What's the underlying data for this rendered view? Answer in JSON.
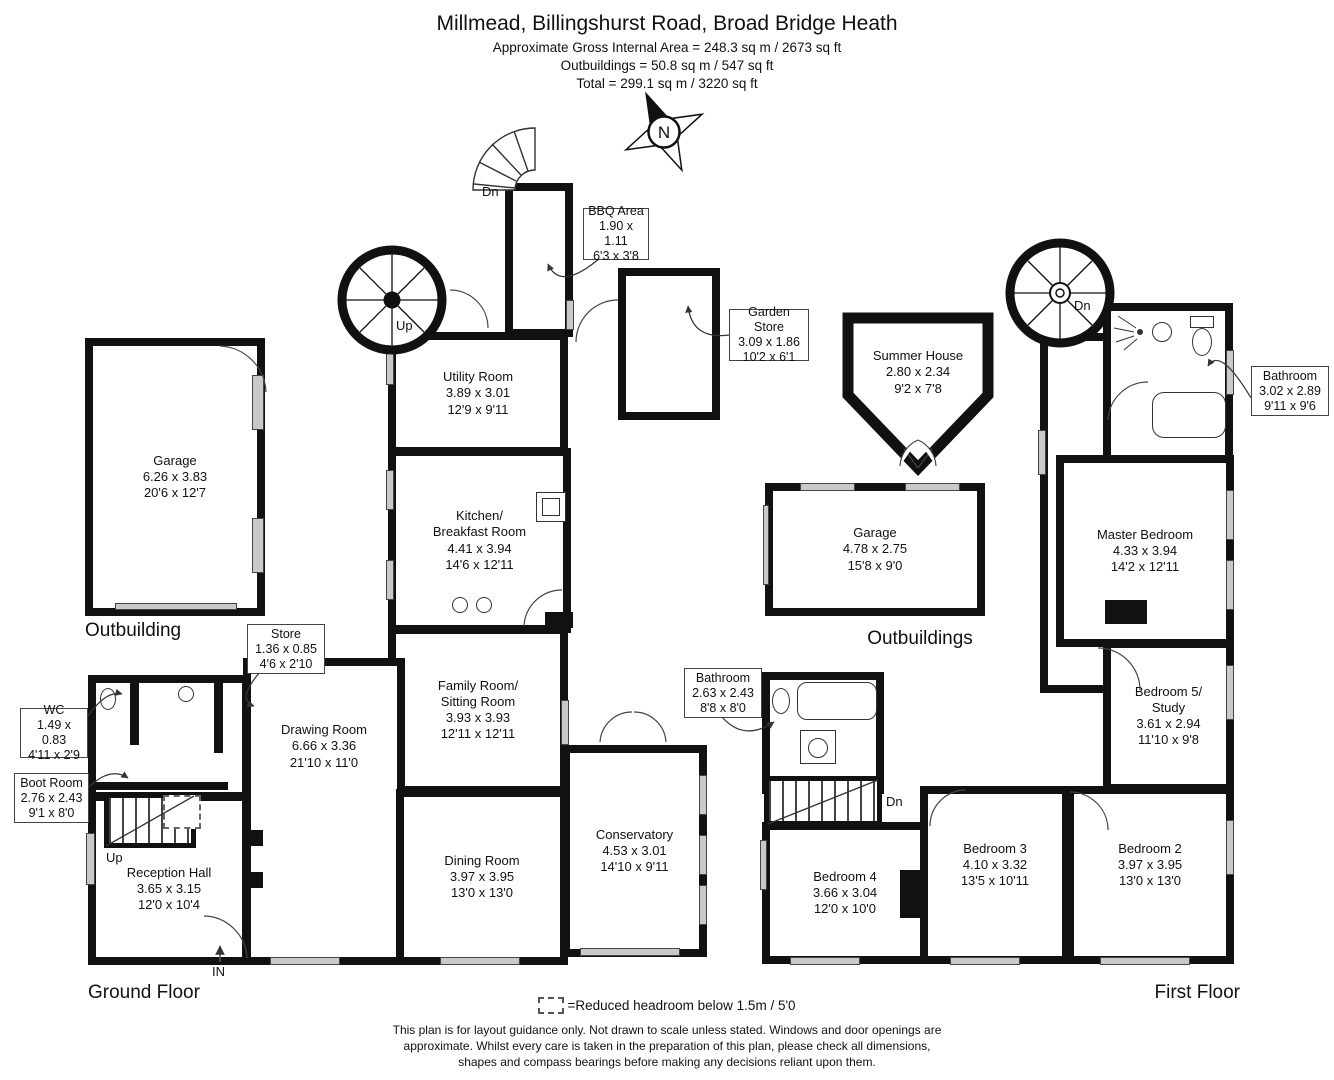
{
  "header": {
    "title": "Millmead, Billingshurst Road, Broad Bridge Heath",
    "area_line1": "Approximate Gross Internal Area = 248.3 sq m / 2673 sq ft",
    "area_line2": "Outbuildings = 50.8 sq m / 547 sq ft",
    "area_line3": "Total = 299.1 sq m / 3220 sq ft"
  },
  "compass": {
    "label": "N"
  },
  "rooms": {
    "garage_left": {
      "name": "Garage",
      "metric": "6.26 x 3.83",
      "imperial": "20'6 x 12'7"
    },
    "utility": {
      "name": "Utility Room",
      "metric": "3.89 x 3.01",
      "imperial": "12'9 x 9'11"
    },
    "kitchen": {
      "name": "Kitchen/\nBreakfast Room",
      "metric": "4.41 x 3.94",
      "imperial": "14'6 x 12'11"
    },
    "family": {
      "name": "Family Room/\nSitting Room",
      "metric": "3.93 x 3.93",
      "imperial": "12'11 x 12'11"
    },
    "drawing": {
      "name": "Drawing Room",
      "metric": "6.66 x 3.36",
      "imperial": "21'10 x 11'0"
    },
    "dining": {
      "name": "Dining Room",
      "metric": "3.97 x 3.95",
      "imperial": "13'0 x 13'0"
    },
    "reception": {
      "name": "Reception Hall",
      "metric": "3.65 x 3.15",
      "imperial": "12'0 x 10'4"
    },
    "conservatory": {
      "name": "Conservatory",
      "metric": "4.53 x 3.01",
      "imperial": "14'10 x 9'11"
    },
    "summer_house": {
      "name": "Summer House",
      "metric": "2.80 x 2.34",
      "imperial": "9'2 x 7'8"
    },
    "garage_right": {
      "name": "Garage",
      "metric": "4.78 x 2.75",
      "imperial": "15'8 x 9'0"
    },
    "master": {
      "name": "Master Bedroom",
      "metric": "4.33 x 3.94",
      "imperial": "14'2 x 12'11"
    },
    "bed5": {
      "name": "Bedroom 5/\nStudy",
      "metric": "3.61 x 2.94",
      "imperial": "11'10 x 9'8"
    },
    "bed2": {
      "name": "Bedroom 2",
      "metric": "3.97 x 3.95",
      "imperial": "13'0 x 13'0"
    },
    "bed3": {
      "name": "Bedroom 3",
      "metric": "4.10 x 3.32",
      "imperial": "13'5 x 10'11"
    },
    "bed4": {
      "name": "Bedroom 4",
      "metric": "3.66 x 3.04",
      "imperial": "12'0 x 10'0"
    }
  },
  "callouts": {
    "bbq": {
      "name": "BBQ Area",
      "metric": "1.90 x 1.11",
      "imperial": "6'3 x 3'8"
    },
    "garden_store": {
      "name": "Garden Store",
      "metric": "3.09 x 1.86",
      "imperial": "10'2 x 6'1"
    },
    "store": {
      "name": "Store",
      "metric": "1.36 x 0.85",
      "imperial": "4'6 x 2'10"
    },
    "wc": {
      "name": "WC",
      "metric": "1.49 x 0.83",
      "imperial": "4'11 x 2'9"
    },
    "boot_room": {
      "name": "Boot Room",
      "metric": "2.76 x 2.43",
      "imperial": "9'1 x 8'0"
    },
    "bathroom1": {
      "name": "Bathroom",
      "metric": "3.02 x 2.89",
      "imperial": "9'11 x 9'6"
    },
    "bathroom2": {
      "name": "Bathroom",
      "metric": "2.63 x 2.43",
      "imperial": "8'8 x 8'0"
    }
  },
  "stairs": {
    "up_spiral": "Up",
    "up_hall": "Up",
    "dn_fan": "Dn",
    "dn_spiral_ff": "Dn",
    "dn_hall_ff": "Dn"
  },
  "entrance": {
    "arrow": "↑",
    "label": "IN"
  },
  "sections": {
    "outbuilding_left": "Outbuilding",
    "outbuildings_right": "Outbuildings",
    "ground_floor": "Ground Floor",
    "first_floor": "First Floor"
  },
  "legend": {
    "text": "=Reduced headroom below 1.5m / 5'0"
  },
  "disclaimer": "This plan is for layout guidance only. Not drawn to scale unless stated. Windows and door openings are approximate. Whilst every care is taken in the preparation of this plan, please check all dimensions, shapes and compass bearings before making any decisions reliant upon them.",
  "colors": {
    "wall": "#111111",
    "window": "#c9c9c9",
    "background": "#ffffff"
  }
}
